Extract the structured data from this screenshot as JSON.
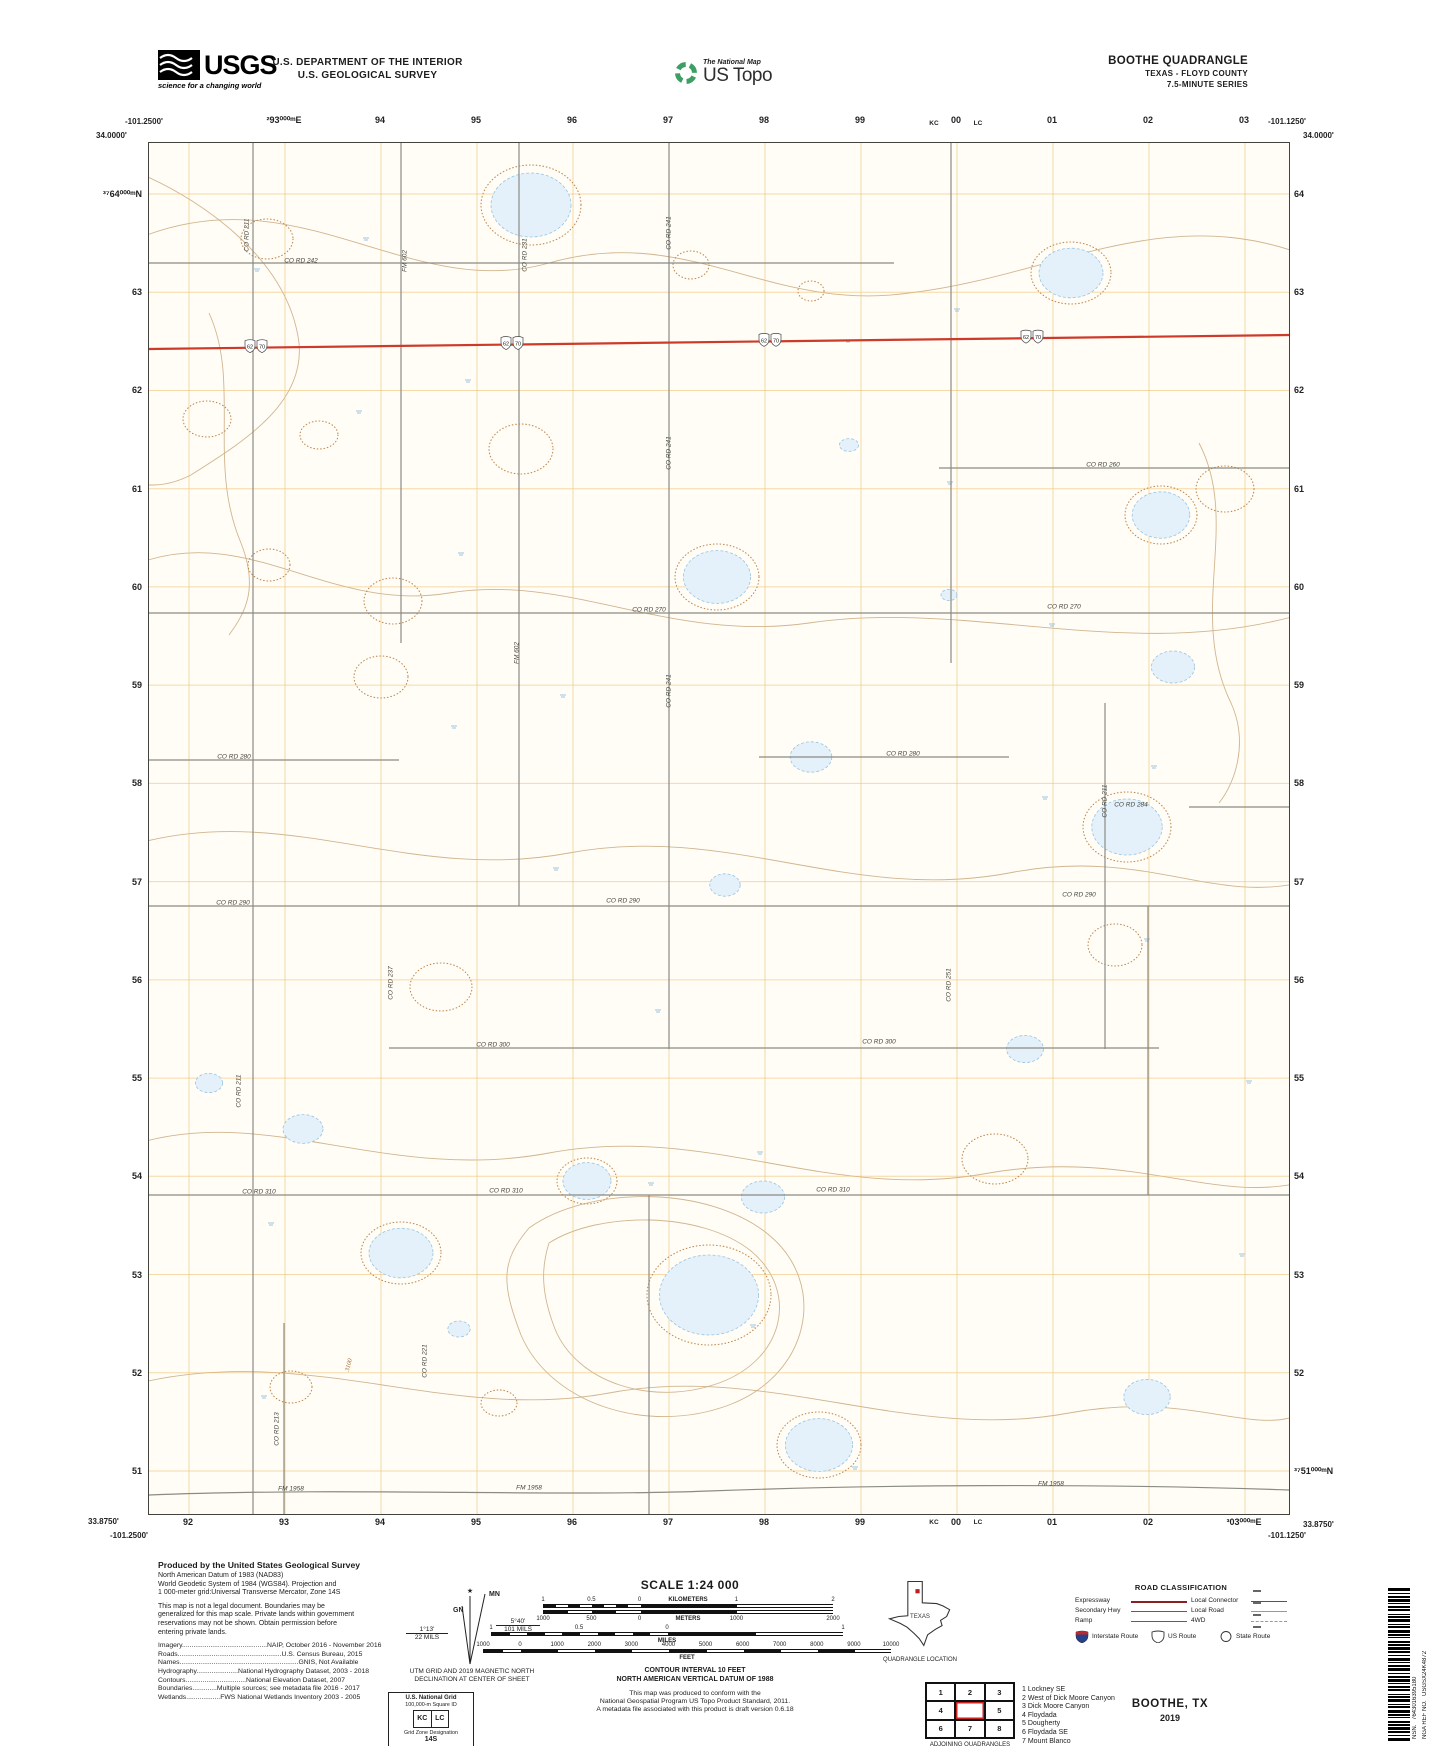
{
  "header": {
    "usgs_logo": "USGS",
    "usgs_tagline": "science for a changing world",
    "dept1": "U.S. DEPARTMENT OF THE INTERIOR",
    "dept2": "U.S. GEOLOGICAL SURVEY",
    "tnm_small": "The National Map",
    "tnm_big": "US Topo",
    "quad_title": "BOOTHE QUADRANGLE",
    "quad_state": "TEXAS - FLOYD COUNTY",
    "quad_series": "7.5-MINUTE SERIES"
  },
  "map": {
    "corners": {
      "top_left_lon": "-101.2500'",
      "top_left_lat": "34.0000'",
      "top_right_lon": "-101.1250'",
      "top_right_lat": "34.0000'",
      "bottom_left_lat": "33.8750'",
      "bottom_left_lon": "-101.2500'",
      "bottom_right_lat": "33.8750'",
      "bottom_right_lon": "-101.1250'"
    },
    "top_eastings": [
      "²93⁰⁰⁰ᵐE",
      "94",
      "95",
      "96",
      "97",
      "98",
      "99",
      "00",
      "01",
      "02",
      "03"
    ],
    "bottom_eastings": [
      "92",
      "93",
      "94",
      "95",
      "96",
      "97",
      "98",
      "99",
      "00",
      "01",
      "02",
      "³03⁰⁰⁰ᵐE"
    ],
    "left_northings": [
      "³⁷64⁰⁰⁰ᵐN",
      "63",
      "62",
      "61",
      "60",
      "59",
      "58",
      "57",
      "56",
      "55",
      "54",
      "53",
      "52",
      "51"
    ],
    "right_northings": [
      "64",
      "63",
      "62",
      "61",
      "60",
      "59",
      "58",
      "57",
      "56",
      "55",
      "54",
      "53",
      "52",
      "³⁷51⁰⁰⁰ᵐN"
    ],
    "square_ids": {
      "top": [
        "KC",
        "LC"
      ],
      "bottom": [
        "KC",
        "LC"
      ]
    },
    "highway_routes": [
      "62",
      "70"
    ],
    "road_labels": [
      {
        "t": "CO RD 242",
        "x": 152,
        "y": 118,
        "r": 0
      },
      {
        "t": "CO RD 211",
        "x": 98,
        "y": 92,
        "r": -90
      },
      {
        "t": "FM 602",
        "x": 256,
        "y": 118,
        "r": -90
      },
      {
        "t": "CO RD 231",
        "x": 376,
        "y": 112,
        "r": -90
      },
      {
        "t": "CO RD 241",
        "x": 520,
        "y": 90,
        "r": -90
      },
      {
        "t": "CO RD 260",
        "x": 954,
        "y": 322,
        "r": 0
      },
      {
        "t": "CO RD 241",
        "x": 520,
        "y": 310,
        "r": -90
      },
      {
        "t": "CO RD 270",
        "x": 500,
        "y": 467,
        "r": 0
      },
      {
        "t": "CO RD 270",
        "x": 915,
        "y": 464,
        "r": 0
      },
      {
        "t": "FM 602",
        "x": 368,
        "y": 510,
        "r": -90
      },
      {
        "t": "CO RD 241",
        "x": 520,
        "y": 548,
        "r": -90
      },
      {
        "t": "CO RD 280",
        "x": 85,
        "y": 614,
        "r": 0
      },
      {
        "t": "CO RD 280",
        "x": 754,
        "y": 611,
        "r": 0
      },
      {
        "t": "CO RD 211",
        "x": 956,
        "y": 658,
        "r": -90
      },
      {
        "t": "CO RD 284",
        "x": 982,
        "y": 662,
        "r": 0
      },
      {
        "t": "CO RD 290",
        "x": 84,
        "y": 760,
        "r": 0
      },
      {
        "t": "CO RD 290",
        "x": 474,
        "y": 758,
        "r": 0
      },
      {
        "t": "CO RD 290",
        "x": 930,
        "y": 752,
        "r": 0
      },
      {
        "t": "CO RD 237",
        "x": 242,
        "y": 840,
        "r": -90
      },
      {
        "t": "CO RD 251",
        "x": 800,
        "y": 842,
        "r": -90
      },
      {
        "t": "CO RD 300",
        "x": 344,
        "y": 902,
        "r": 0
      },
      {
        "t": "CO RD 300",
        "x": 730,
        "y": 899,
        "r": 0
      },
      {
        "t": "CO RD 211",
        "x": 90,
        "y": 948,
        "r": -90
      },
      {
        "t": "CO RD 310",
        "x": 110,
        "y": 1049,
        "r": 0
      },
      {
        "t": "CO RD 310",
        "x": 357,
        "y": 1048,
        "r": 0
      },
      {
        "t": "CO RD 310",
        "x": 684,
        "y": 1047,
        "r": 0
      },
      {
        "t": "CO RD 221",
        "x": 276,
        "y": 1218,
        "r": -90
      },
      {
        "t": "CO RD 213",
        "x": 128,
        "y": 1286,
        "r": -90
      },
      {
        "t": "FM 1958",
        "x": 142,
        "y": 1346,
        "r": 0
      },
      {
        "t": "FM 1958",
        "x": 380,
        "y": 1345,
        "r": 0
      },
      {
        "t": "FM 1958",
        "x": 902,
        "y": 1341,
        "r": 0
      }
    ],
    "contour_labels": [
      {
        "t": "3100",
        "x": 200,
        "y": 1222,
        "r": -75
      }
    ]
  },
  "produced": {
    "title": "Produced by the United States Geological Survey",
    "para1": [
      "North American Datum of 1983 (NAD83)",
      "World Geodetic System of 1984 (WGS84).  Projection and",
      "1 000-meter grid:Universal Transverse Mercator, Zone 14S"
    ],
    "para2": [
      "This map is not a legal document. Boundaries may be",
      "generalized for this map scale. Private lands within government",
      "reservations may not be shown. Obtain permission before",
      "entering private lands."
    ],
    "sources": [
      "Imagery.............................................NAIP, October 2016 - November 2016",
      "Roads.......................................................U.S. Census Bureau, 2015",
      "Names...............................................................GNIS, Not Available",
      "Hydrography......................National Hydrography Dataset, 2003 - 2018",
      "Contours................................National Elevation Dataset, 2007",
      "Boundaries.............Multiple sources; see metadata file 2016 - 2017",
      "Wetlands..................FWS National Wetlands Inventory 2003 - 2005"
    ]
  },
  "declination": {
    "mn": "MN",
    "gn": "GN",
    "right_angle": "5°40'",
    "right_mils": "101 MILS",
    "left_angle": "1°13'",
    "left_mils": "22 MILS",
    "caption1": "UTM GRID AND 2019 MAGNETIC NORTH",
    "caption2": "DECLINATION AT CENTER OF SHEET"
  },
  "usng": {
    "title": "U.S. National Grid",
    "subtitle": "100,000-m Square ID",
    "ids": [
      "KC",
      "LC"
    ],
    "gzd_label": "Grid Zone Designation",
    "gzd": "14S"
  },
  "scale": {
    "title": "SCALE 1:24 000",
    "bars": [
      {
        "unit": "KILOMETERS",
        "labels": [
          "1",
          "0.5",
          "0",
          "1",
          "2"
        ]
      },
      {
        "unit": "METERS",
        "labels": [
          "1000",
          "500",
          "0",
          "1000",
          "2000"
        ]
      },
      {
        "unit": "MILES",
        "labels": [
          "1",
          "0.5",
          "0",
          "1"
        ]
      },
      {
        "unit": "FEET",
        "labels": [
          "1000",
          "0",
          "1000",
          "2000",
          "3000",
          "4000",
          "5000",
          "6000",
          "7000",
          "8000",
          "9000",
          "10000"
        ]
      }
    ]
  },
  "contour_note": {
    "line1": "CONTOUR INTERVAL 10 FEET",
    "line2": "NORTH AMERICAN VERTICAL DATUM OF 1988"
  },
  "standard_note": [
    "This map was produced to conform with the",
    "National Geospatial Program US Topo Product Standard, 2011.",
    "A metadata file associated with this product is draft version 0.6.18"
  ],
  "location": {
    "state_label": "TEXAS",
    "caption": "QUADRANGLE LOCATION"
  },
  "adjoining": {
    "cells": [
      "1",
      "2",
      "3",
      "4",
      "",
      "5",
      "6",
      "7",
      "8"
    ],
    "names": [
      "1 Lockney SE",
      "2 West of Dick Moore Canyon",
      "3 Dick Moore Canyon",
      "4 Floydada",
      "5 Dougherty",
      "6 Floydada SE",
      "7 Mount Blanco",
      "8 Wake"
    ],
    "caption": "ADJOINING QUADRANGLES"
  },
  "road_class": {
    "title": "ROAD CLASSIFICATION",
    "rows": [
      {
        "left": "Expressway",
        "right": "Local Connector"
      },
      {
        "left": "Secondary Hwy",
        "right": "Local Road"
      },
      {
        "left": "Ramp",
        "right": "4WD"
      }
    ],
    "shields": [
      "Interstate Route",
      "US Route",
      "State Route"
    ]
  },
  "title_block": {
    "name": "BOOTHE, TX",
    "year": "2019"
  },
  "ref": {
    "nsn_label": "NSN.",
    "nsn": "7643016395180",
    "nga_label": "NGA REF NO.",
    "nga": "USGSX24K4872"
  },
  "colors": {
    "highway_red": "#cd3a2a",
    "expressway": "#8c1f1f",
    "secondary": "#c03a2c",
    "utm_grid_orange": "#eebd6a",
    "contour_brown": "#c9a87c",
    "water_blue": "#96c4e2",
    "tnm_green": "#3e9e63",
    "interstate_blue": "#26408b"
  }
}
